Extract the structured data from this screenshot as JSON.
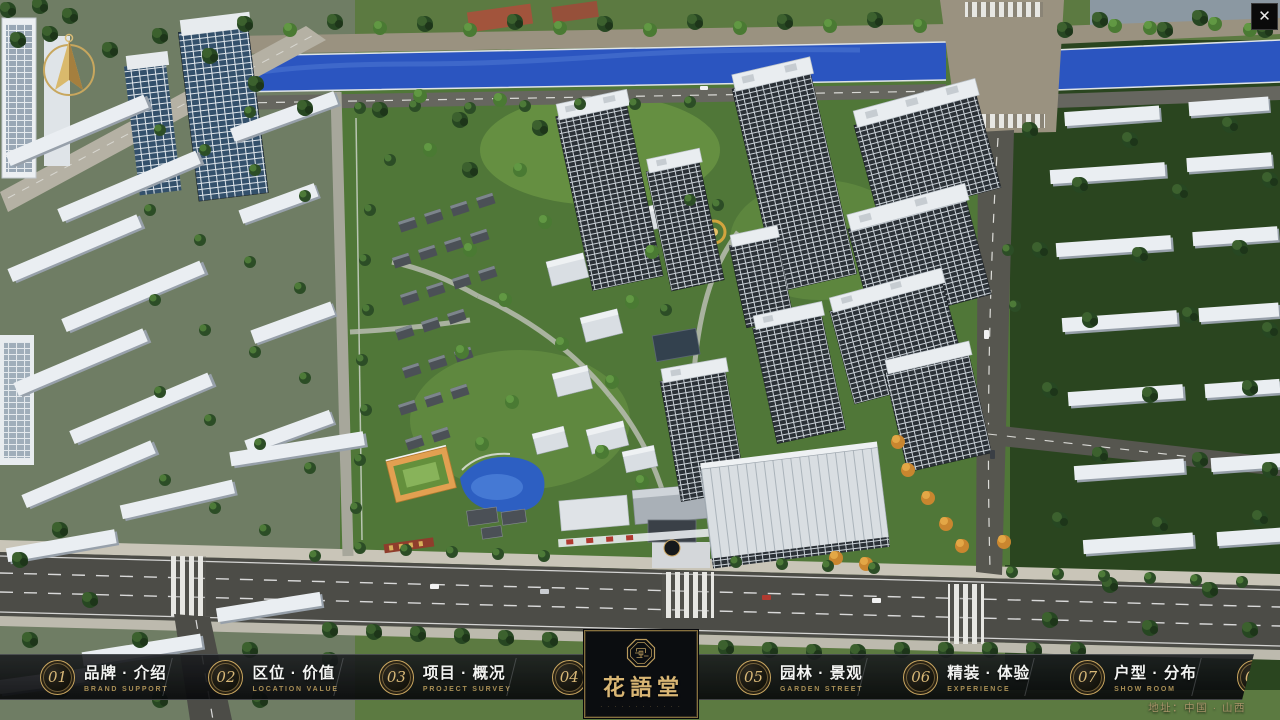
{
  "chrome": {
    "close_glyph": "✕"
  },
  "logo": {
    "name": "花語堂",
    "subtitle": "· · · · · · · · · · · ·"
  },
  "menu": {
    "items": [
      {
        "num": "01",
        "zh": "品牌 · 介绍",
        "en": "BRAND SUPPORT"
      },
      {
        "num": "02",
        "zh": "区位 · 价值",
        "en": "LOCATION VALUE"
      },
      {
        "num": "03",
        "zh": "项目 · 概况",
        "en": "PROJECT SURVEY"
      },
      {
        "num": "04",
        "zh": "建筑 · 鉴赏",
        "en": "APPRECIATION"
      },
      {
        "num": "05",
        "zh": "园林 · 景观",
        "en": "GARDEN STREET"
      },
      {
        "num": "06",
        "zh": "精装 · 体验",
        "en": "EXPERIENCE"
      },
      {
        "num": "07",
        "zh": "户型 · 分布",
        "en": "SHOW ROOM"
      },
      {
        "num": "08",
        "zh": "一房 · 一景",
        "en": "COMMUNITY"
      }
    ]
  },
  "footer": {
    "address": "地址：中国 · 山西"
  },
  "colors": {
    "gold": "#c9a660",
    "bar_background": "rgba(10,12,15,0.88)",
    "river_blue": "#2b55c0",
    "site_green": "#507738",
    "road_gray": "#4c4c47"
  }
}
